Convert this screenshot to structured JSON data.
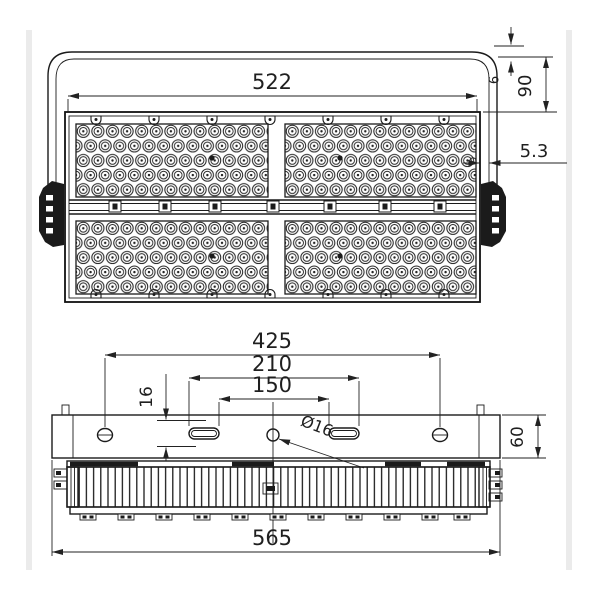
{
  "front_view": {
    "width": "522",
    "bracket_thickness": "6",
    "bracket_height": "90",
    "gap": "5.3"
  },
  "bottom_view": {
    "hole_spacing": "425",
    "slot_outer_spacing": "210",
    "slot_inner_spacing": "150",
    "slot_offset": "16",
    "hole_diameter": "Ø16",
    "bracket_plate_height": "60",
    "overall_width": "565"
  }
}
